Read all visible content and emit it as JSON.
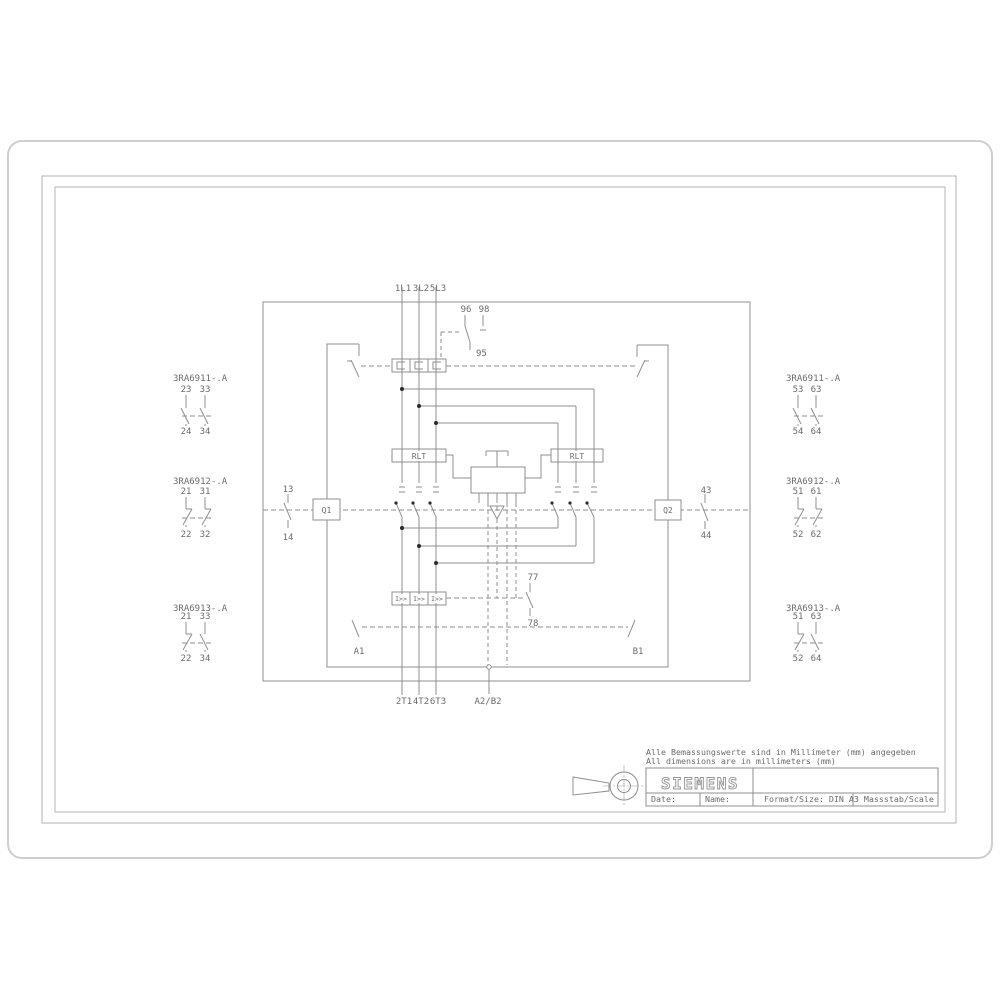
{
  "colors": {
    "line": "#8f8f8f",
    "text": "#6b6b6b",
    "outer_border": "#cfcfcf",
    "frame": "#b3b3b3",
    "junction_dot": "#2b2b2b"
  },
  "schematic": {
    "top_terminals": [
      "1L1",
      "3L2",
      "5L3"
    ],
    "bottom_terminals": [
      "2T1",
      "4T2",
      "6T3"
    ],
    "coil_terminal": "A2/B2",
    "overload_aux": {
      "common": "95",
      "nc": "96",
      "no": "98"
    },
    "rlt_label": "RLT",
    "overcurrent_label": "I>>",
    "contactor_left": "Q1",
    "contactor_right": "Q2",
    "q1_aux": {
      "top": "13",
      "bottom": "14"
    },
    "q2_aux": {
      "top": "43",
      "bottom": "44"
    },
    "trip_contact": {
      "top": "77",
      "bottom": "78"
    },
    "coil_left": "A1",
    "coil_right": "B1",
    "aux_left": [
      {
        "part": "3RA6911-.A",
        "top": [
          "23",
          "33"
        ],
        "bottom": [
          "24",
          "34"
        ]
      },
      {
        "part": "3RA6912-.A",
        "top": [
          "21",
          "31"
        ],
        "bottom": [
          "22",
          "32"
        ]
      },
      {
        "part": "3RA6913-.A",
        "top": [
          "21",
          "33"
        ],
        "bottom": [
          "22",
          "34"
        ]
      }
    ],
    "aux_right": [
      {
        "part": "3RA6911-.A",
        "top": [
          "53",
          "63"
        ],
        "bottom": [
          "54",
          "64"
        ]
      },
      {
        "part": "3RA6912-.A",
        "top": [
          "51",
          "61"
        ],
        "bottom": [
          "52",
          "62"
        ]
      },
      {
        "part": "3RA6913-.A",
        "top": [
          "51",
          "63"
        ],
        "bottom": [
          "52",
          "64"
        ]
      }
    ]
  },
  "title_block": {
    "note_de": "Alle Bemassungswerte sind in Millimeter (mm) angegeben",
    "note_en": "All dimensions are in millimeters (mm)",
    "brand": "SIEMENS",
    "date_label": "Date:",
    "name_label": "Name:",
    "format_label": "Format/Size: DIN A3 Massstab/Scale"
  }
}
